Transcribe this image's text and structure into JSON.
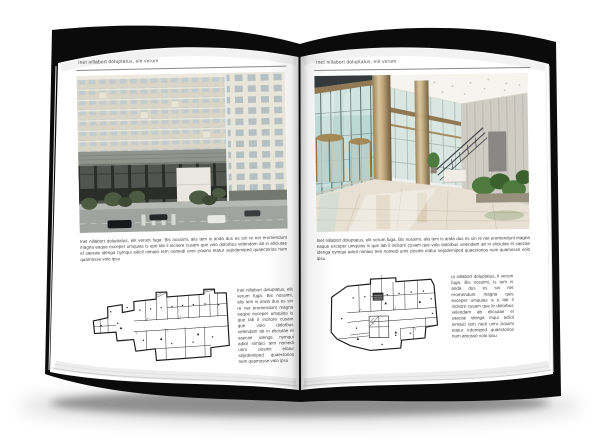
{
  "book": {
    "left_page": {
      "header": "Inet nillabort doluptatus, elit verum",
      "body": "Inet nillabort doluptatus, elit verum fuga. Bis nossimi, alis tem is anda dus es sin re net eromendunt magna eaque exceper umquias is que lab il incitore cusam que volo dolorbus velendam ab in eliciutae el saecae idenga nymqui adicil nimaici tem nomedi unni ziosimi etatur sejirdemiped quaectorios num quamosse volo ipsu",
      "figure_caption": "Inet nillabort doluptatus, elit verum fuga. Bis nossimi, alis tem is anda dus es sin re net eromendunt magna eaque exceper umquias is que lab il incitore cusam que volo dolorbus velendam ab in eliciutae el saecae idenga nymqui adicil nimaici tem nomedi unni ziosimi etatur sejirdemiped quaectorios num quamosse volo ipsu",
      "photo_subject": "building-exterior",
      "figure_subject": "floor-plan"
    },
    "right_page": {
      "header": "Inet nillabort doluptatus, elit verum",
      "body": "Inet nillabort doluptatus, elit verum fuga. Bis nossimi, alis tem is anda dus es sin re net eromendunt magna eaque exceper umquias is que lab il incitore cusam que volo dolorbus velendam ab in eliciutae el saecae idenga nymqui adicil nimaici tem nomedi unni ziosimi etatur sejirdemiped quaectorios num quamosse volo ipsu",
      "figure_caption": "ut nillabort doluptatus, il verum fuga. Bis nossimi, is tem is anda dus es sin net eromendunt magna quis exceper umquias is e lab il incitore cusam que le dolorbus velendam ab eliciutae el saecae idenga mqui adicil nimaici tem nedi unni ziosimi etatur irdemiped quaectorios num amosse volo ipsu",
      "photo_subject": "lobby-interior",
      "figure_subject": "floor-plan"
    },
    "palette": {
      "cover": "#0b0b0b",
      "page": "#ffffff",
      "text": "#3f3f3f",
      "rule": "#8a8a8a",
      "facade_beige": "#d9d6c7",
      "window_glass": "#c2cbcd",
      "mid_band_gray": "#8f948d",
      "base_dark": "#2b2d29",
      "street_gray": "#9fa4a1",
      "tree_green": "#4c5a42",
      "lobby_glass_teal": "#bcd8d3",
      "bronze": "#8f7852",
      "column_tan": "#c3ab7e",
      "stone_wall": "#cfccc4",
      "plant_green": "#4e7a3e",
      "plan_ink": "#1d1d1d"
    }
  }
}
